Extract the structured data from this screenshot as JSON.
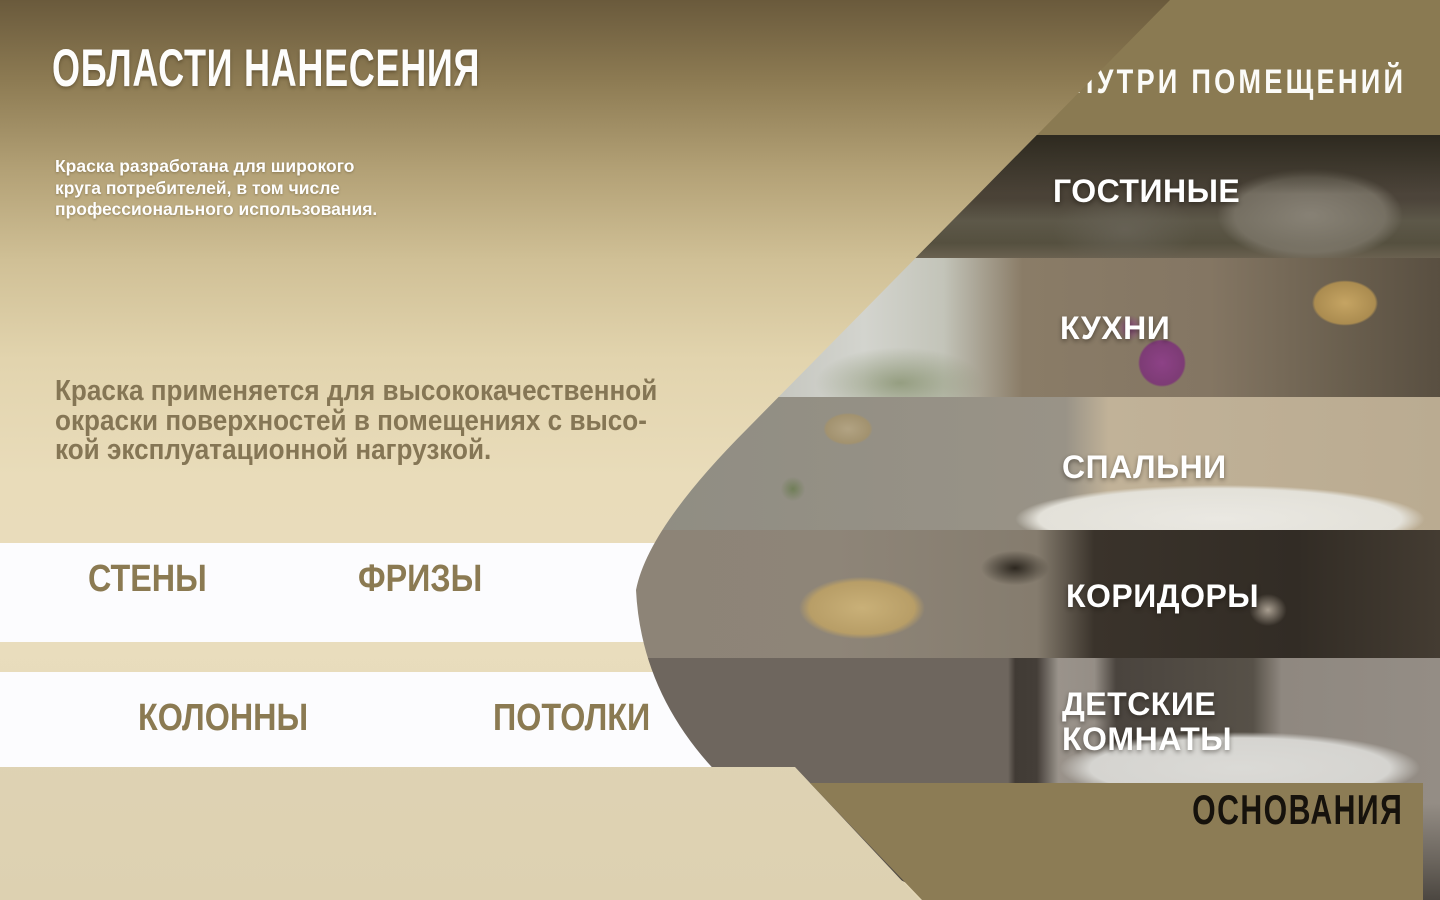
{
  "header": {
    "title": "ОБЛАСТИ НАНЕСЕНИЯ"
  },
  "intro": {
    "text": "Краска разработана для широкого\nкруга потребителей, в том числе\nпрофессионального использования."
  },
  "description": {
    "text": "Краска применяется для высококачественной\nокраски поверхностей в помещениях с высо-\nкой эксплуатационной нагрузкой."
  },
  "surface_bands": [
    {
      "labels": [
        {
          "text": "СТЕНЫ"
        },
        {
          "text": "ФРИЗЫ"
        }
      ]
    },
    {
      "labels": [
        {
          "text": "КОЛОННЫ"
        },
        {
          "text": "ПОТОЛКИ"
        }
      ]
    }
  ],
  "interior": {
    "header": "ВНУТРИ ПОМЕЩЕНИЙ",
    "rooms": [
      {
        "label": "ГОСТИНЫЕ"
      },
      {
        "label": "КУХНИ"
      },
      {
        "label": "СПАЛЬНИ"
      },
      {
        "label": "КОРИДОРЫ"
      },
      {
        "label": "ДЕТСКИЕ\nКОМНАТЫ"
      }
    ]
  },
  "footer": {
    "label": "ОСНОВАНИЯ"
  },
  "colors": {
    "khaki_band": "#8a7a52",
    "surface_label_text": "#8b7a52",
    "description_text": "#857655",
    "white_band": "#fcfcfe",
    "tan_band": "#e3d8bc",
    "footer_text": "#16120c",
    "heading_text": "#fdfdfc"
  }
}
